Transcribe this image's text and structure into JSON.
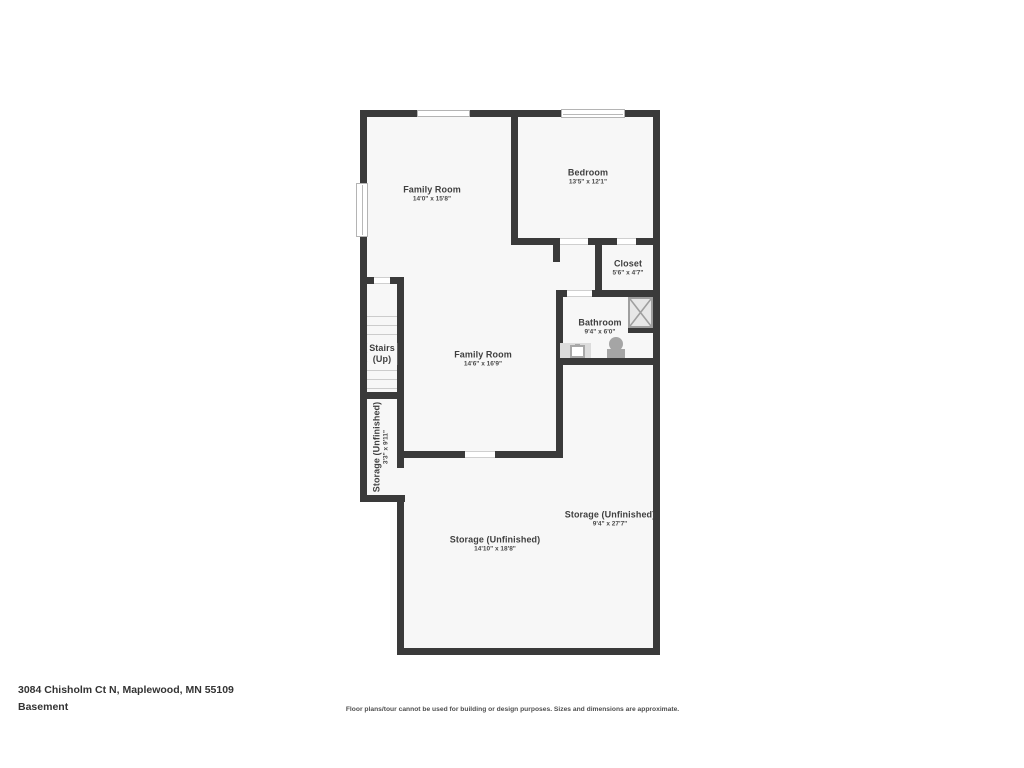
{
  "page": {
    "address": "3084 Chisholm Ct N, Maplewood, MN 55109",
    "floor_label": "Basement",
    "disclaimer": "Floor plans/tour cannot be used for building or design purposes. Sizes and dimensions are approximate."
  },
  "rooms": {
    "family_room_top": {
      "name": "Family Room",
      "dims": "14'0\" x 15'8\""
    },
    "bedroom": {
      "name": "Bedroom",
      "dims": "13'5\" x 12'1\""
    },
    "closet": {
      "name": "Closet",
      "dims": "5'6\" x 4'7\""
    },
    "bathroom": {
      "name": "Bathroom",
      "dims": "9'4\" x 6'0\""
    },
    "stairs": {
      "line1": "Stairs",
      "line2": "(Up)"
    },
    "family_room_center": {
      "name": "Family Room",
      "dims": "14'6\" x 16'9\""
    },
    "storage_left": {
      "name": "Storage (Unfinished)",
      "dims": "3'3\" x 9'11\""
    },
    "storage_right": {
      "name": "Storage (Unfinished)",
      "dims": "9'4\" x 27'7\""
    },
    "storage_bottom": {
      "name": "Storage (Unfinished)",
      "dims": "14'10\" x 18'8\""
    }
  },
  "colors": {
    "wall": "#3a3a3a",
    "room_fill": "#f7f7f7",
    "label_text": "#3f3f3f"
  }
}
